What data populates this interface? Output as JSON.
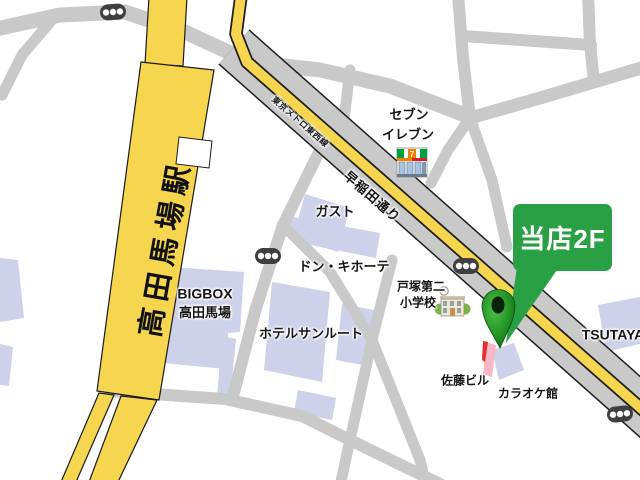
{
  "colors": {
    "railway_yellow": "#f6d54f",
    "road_gray": "#c9c9c9",
    "building_lavender": "#cdd1ea",
    "callout_green": "#2aa045",
    "pin_green": "#1f8f1f",
    "marker_pink": "#f5b8c4",
    "marker_red": "#e03030",
    "traffic_light_gray": "#3f3f3f"
  },
  "station": {
    "name": "高田馬場駅"
  },
  "roads": {
    "waseda_dori": "早稲田通り",
    "tozai_line": "東京メトロ東西線"
  },
  "places": {
    "seven_eleven": {
      "line1": "セブン",
      "line2": "イレブン"
    },
    "gusto": {
      "label": "ガスト"
    },
    "don_quijote": {
      "label": "ドン・キホーテ"
    },
    "bigbox": {
      "line1": "BIGBOX",
      "line2": "高田馬場"
    },
    "hotel_sunroute": {
      "label": "ホテルサンルート"
    },
    "totsuka_daini_school": {
      "line1": "戸塚第二",
      "line2": "小学校"
    },
    "sato_building": {
      "label": "佐藤ビル"
    },
    "karaoke_kan": {
      "label": "カラオケ館"
    },
    "tsutaya": {
      "label": "TSUTAYA"
    }
  },
  "callout": {
    "label": "当店2F"
  },
  "icons": {
    "seven_eleven_glyph": "7"
  }
}
